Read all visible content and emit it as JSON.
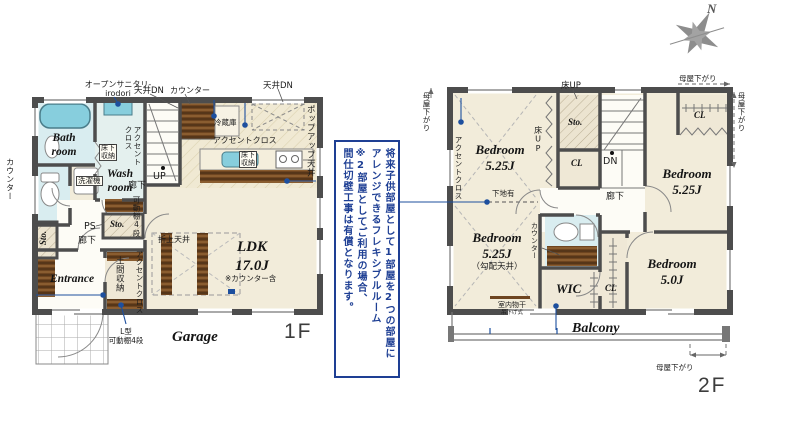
{
  "compass": {
    "north": "N"
  },
  "callout": {
    "line1": "将来子供部屋として1部屋を2つの部屋に",
    "line2": "アレンジできるフレキシブルルーム",
    "line3": "※2部屋としてご利用の場合、",
    "line4": "間仕切壁工事は有償となります。"
  },
  "f1": {
    "floor_label": "1F",
    "garage": "Garage",
    "bath": "Bath\nroom",
    "wash": "Wash\nroom",
    "entrance": "Entrance",
    "ldk": "LDK\n17.0J",
    "ldk_note": "※カウンター含",
    "corridor_a": "廊下",
    "corridor_b": "廊下",
    "ps": "PS",
    "sto_a": "Sto.",
    "sto_b": "Sto.",
    "up": "UP",
    "doma": "土間収納",
    "open_sanitary_1": "オープンサニタリ-",
    "open_sanitary_2": "irodori",
    "ceiling_dn_a": "天井DN",
    "ceiling_dn_b": "天井DN",
    "counter_a": "カウンター",
    "counter_b": "カウンター",
    "popup": "ポップアップ天井",
    "fridge": "冷蔵庫",
    "accent_a": "アクセントクロス",
    "accent_b": "アクセント\nクロス",
    "accent_c": "アクセントクロス",
    "underfloor_a": "床下\n収納",
    "underfloor_b": "床下\n収納",
    "washer": "洗濯機",
    "shelf_a": "可動棚4段",
    "shelf_b": "L型\n可動棚4段",
    "oriage": "折上天井"
  },
  "f2": {
    "floor_label": "2F",
    "balcony": "Balcony",
    "bed1": "Bedroom\n5.25J",
    "bed2": "Bedroom\n5.25J",
    "bed3": "Bedroom\n5.25J",
    "bed3_note": "（勾配天井）",
    "bed4": "Bedroom\n5.0J",
    "wic": "WIC",
    "cl_a": "CL",
    "cl_b": "CL",
    "cl_c": "CL",
    "sto": "Sto.",
    "dn": "DN",
    "corridor": "廊下",
    "yuka_up_a": "床UP",
    "yuka_up_b": "床UP",
    "moya_a": "母屋下がり",
    "moya_b": "母屋下がり",
    "moya_c": "母屋下がり",
    "moya_d": "母屋下がり",
    "accent": "アクセントクロス",
    "shitaji": "下地有",
    "monohoshi_1": "室内物干",
    "monohoshi_2": "吊下げ式",
    "counter": "カウンター"
  }
}
